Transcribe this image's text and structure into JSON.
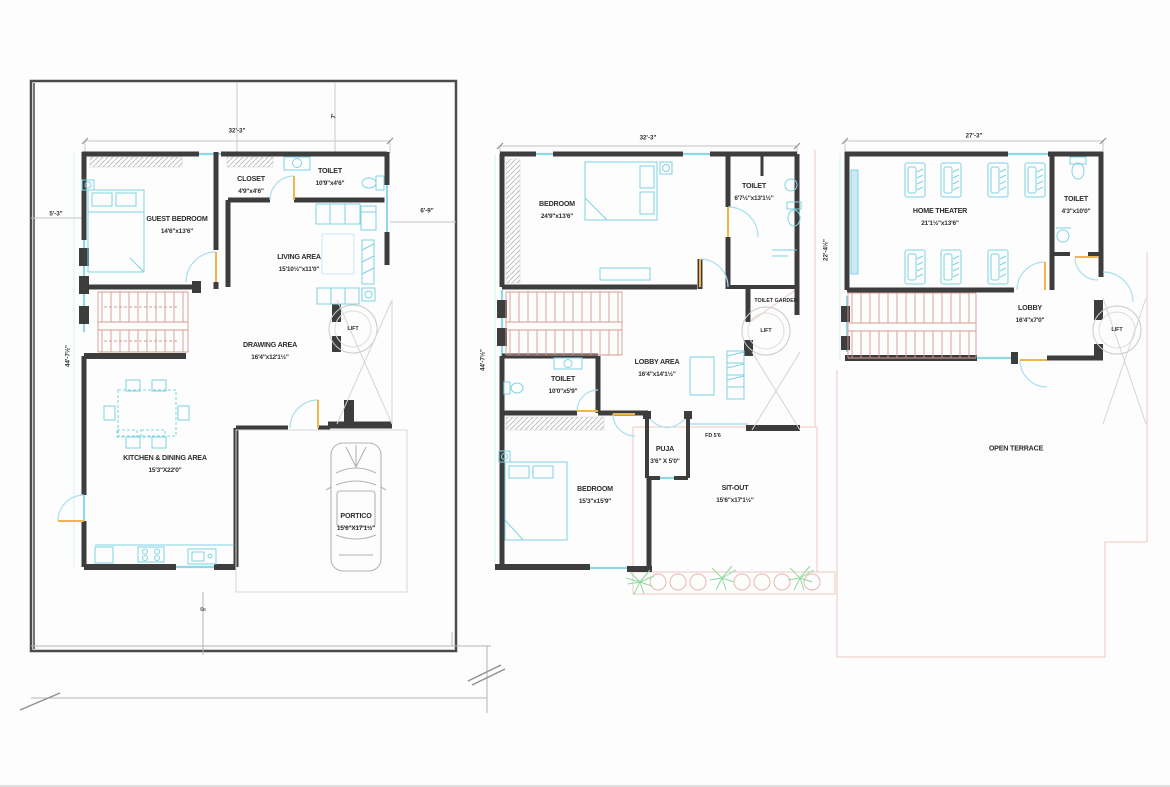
{
  "title": "Residential three-level floor plan drawing",
  "colors": {
    "wall": "#3d3d3d",
    "furniture": "#7fd4e4",
    "stairs": "#d89a90",
    "door_leaf": "#f0b54a",
    "plants": "#8fd9a0",
    "plot_pink": "#eec8c0"
  },
  "plans": {
    "ground": {
      "dims": {
        "top_width": "32'-3\"",
        "top_offset": "7'",
        "left_small": "5'-3\"",
        "left_height": "44'-7½\"",
        "right_offset": "6'-9\""
      },
      "rooms": {
        "guest_bedroom": {
          "name": "GUEST BEDROOM",
          "size": "14'6\"x13'6\""
        },
        "closet": {
          "name": "CLOSET",
          "size": "4'9\"x4'6\""
        },
        "toilet": {
          "name": "TOILET",
          "size": "10'9\"x4'6\""
        },
        "living": {
          "name": "LIVING AREA",
          "size": "15'10½\"x11'0\""
        },
        "drawing": {
          "name": "DRAWING AREA",
          "size": "16'4\"x12'1½\""
        },
        "kitchen": {
          "name": "KITCHEN & DINING AREA",
          "size": "15'3\"X22'0\""
        },
        "portico": {
          "name": "PORTICO",
          "size": "15'6\"X17'1½\""
        },
        "lift": {
          "name": "LIFT"
        }
      },
      "note": "6o"
    },
    "first": {
      "dims": {
        "top_width": "32'-3\"",
        "left_height": "44'-7½\""
      },
      "rooms": {
        "bedroom": {
          "name": "BEDROOM",
          "size": "24'9\"x13'6\""
        },
        "toilet_top": {
          "name": "TOILET",
          "size": "6'7½\"x13'1½\""
        },
        "toilet_garden": {
          "name": "TOILET GARDEN"
        },
        "lift": {
          "name": "LIFT"
        },
        "lobby": {
          "name": "LOBBY AREA",
          "size": "16'4\"x14'1½\""
        },
        "toilet_mid": {
          "name": "TOILET",
          "size": "10'0\"x5'9\""
        },
        "puja": {
          "name": "PUJA",
          "size": "3'6\" X 5'0\""
        },
        "fd": {
          "name": "FD 5'6"
        },
        "bedroom2": {
          "name": "BEDROOM",
          "size": "15'3\"x15'9\""
        },
        "sitout": {
          "name": "SIT-OUT",
          "size": "15'6\"x17'1½\""
        }
      }
    },
    "second": {
      "dims": {
        "top_width": "27'-3\"",
        "left_height": "22'-4½\""
      },
      "rooms": {
        "home_theater": {
          "name": "HOME THEATER",
          "size": "21'1½\"x13'6\""
        },
        "toilet": {
          "name": "TOILET",
          "size": "4'3\"x10'0\""
        },
        "lobby": {
          "name": "LOBBY",
          "size": "16'4\"x7'0\""
        },
        "lift": {
          "name": "LIFT"
        },
        "terrace": {
          "name": "OPEN TERRACE"
        }
      }
    }
  }
}
